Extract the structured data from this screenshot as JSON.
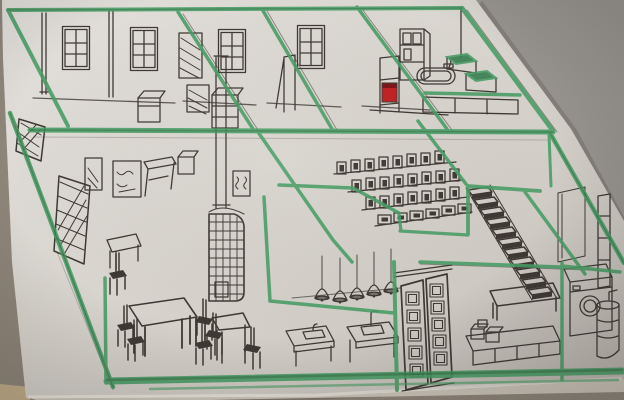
{
  "scene": {
    "title": "Photographed hand-drawn isometric cutaway floor plan of a house — black ink sketch with green marker structural lines on a cut sheet of paper",
    "depicted_objects": [
      "bedroom windows",
      "chimney pipes",
      "hatched wardrobe",
      "bathroom cabinet",
      "bathtub",
      "red boiler",
      "tiled stove",
      "picture frames",
      "wall desk",
      "dining table with chairs",
      "square table",
      "kitchen counters with sinks",
      "pendant lamps",
      "bookshelf with books",
      "staircase",
      "entrance double door",
      "kitchen island",
      "washing machine",
      "water heater"
    ]
  },
  "palette": {
    "paper": "#d8d4cd",
    "backdrop": "#8d8478",
    "backdrop_light": "#96938e",
    "table_tan": "#c2ae87",
    "undersheet": "#cdc7bb",
    "edge_light": "#f2efe7",
    "shadow": "#6b645b",
    "pencil": "#958d84",
    "ink": "#3c3631",
    "marker_green": "#449c63",
    "marker_green_dark": "#2f7c49",
    "red_accent": "#c11d1f",
    "red_dark": "#7d1113"
  }
}
